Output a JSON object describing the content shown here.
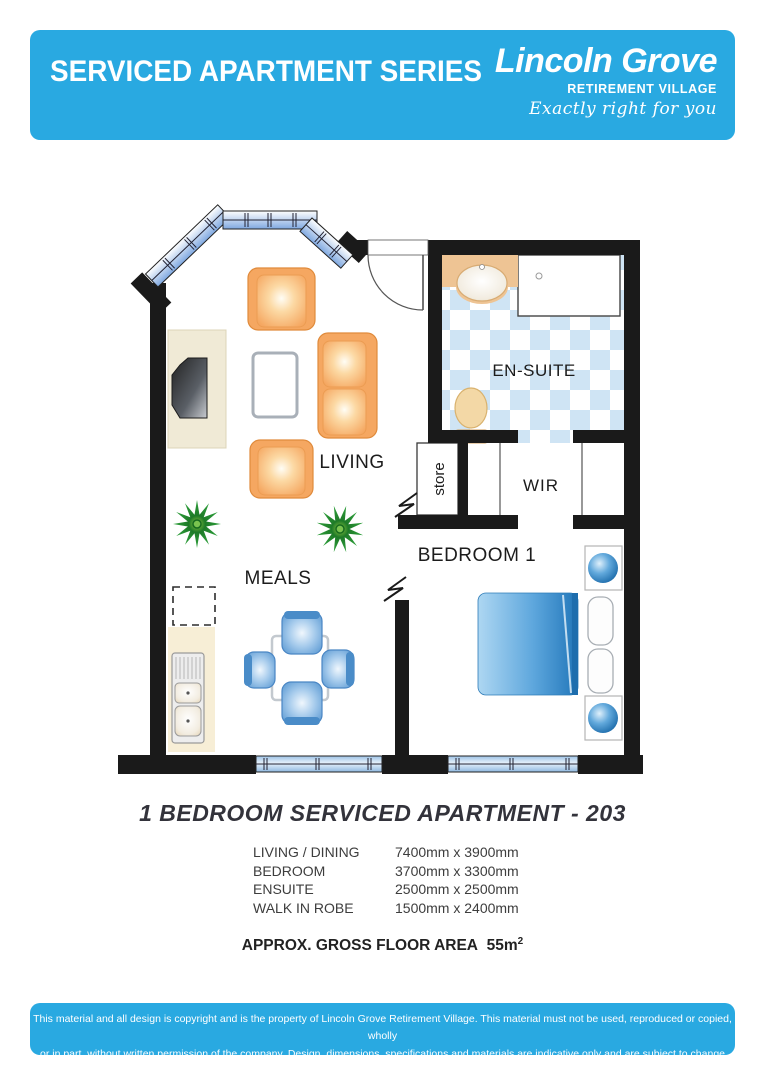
{
  "header": {
    "series_title": "SERVICED APARTMENT SERIES",
    "brand_name": "Lincoln Grove",
    "brand_sub": "RETIREMENT VILLAGE",
    "brand_tagline": "Exactly right for you"
  },
  "floorplan": {
    "rooms": {
      "living": "LIVING",
      "meals": "MEALS",
      "ensuite": "EN-SUITE",
      "wir": "WIR",
      "store": "store",
      "bedroom": "BEDROOM 1"
    }
  },
  "plan_title": "1 BEDROOM SERVICED APARTMENT - 203",
  "dimensions": {
    "rows": [
      {
        "label": "LIVING / DINING",
        "value": "7400mm x 3900mm"
      },
      {
        "label": "BEDROOM",
        "value": "3700mm x 3300mm"
      },
      {
        "label": "ENSUITE",
        "value": "2500mm x 2500mm"
      },
      {
        "label": "WALK IN ROBE",
        "value": "1500mm x 2400mm"
      }
    ],
    "area_label": "APPROX. GROSS FLOOR AREA",
    "area_value": "55m",
    "area_sup": "2"
  },
  "footer": {
    "line1": "This material and all design is copyright and is the property of Lincoln Grove Retirement Village. This material must not be used, reproduced or copied, wholly",
    "line2": "or in part, without written permission of the company. Design, dimensions, specifications and materials are indicative only and are subject to change without notice."
  },
  "colors": {
    "brand_blue": "#29a9e1",
    "tile_blue": "#cfe4f4",
    "furniture_orange": "#f5a761",
    "bed_blue": "#3f93d4",
    "plant_green": "#2fa33c",
    "wall_black": "#1a1a1a"
  }
}
